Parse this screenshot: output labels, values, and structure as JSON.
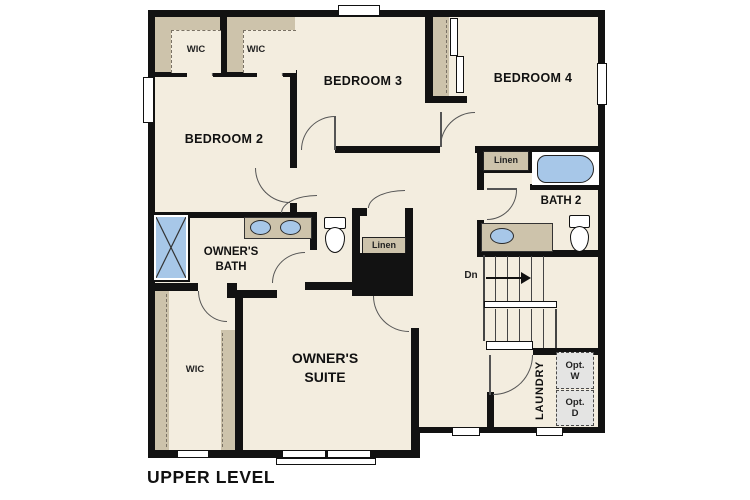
{
  "title": "UPPER LEVEL",
  "rooms": {
    "bedroom2": "BEDROOM 2",
    "bedroom3": "BEDROOM 3",
    "bedroom4": "BEDROOM 4",
    "owners_bath_line1": "OWNER'S",
    "owners_bath_line2": "BATH",
    "owners_suite_line1": "OWNER'S",
    "owners_suite_line2": "SUITE",
    "bath2": "BATH 2",
    "wic_top_left": "WIC",
    "wic_top_right": "WIC",
    "wic_owner": "WIC",
    "linen_hall": "Linen",
    "linen_bath2": "Linen",
    "laundry": "LAUNDRY"
  },
  "stairs": {
    "direction_label": "Dn"
  },
  "appliances": {
    "washer_line1": "Opt.",
    "washer_line2": "W",
    "dryer_line1": "Opt.",
    "dryer_line2": "D"
  },
  "colors": {
    "floor": "#f3eddf",
    "wall": "#121212",
    "closet_shelf": "#cdc3ab",
    "fixture_blue": "#a7c7e8",
    "optional_appliance_gray": "#e4e4e3"
  }
}
